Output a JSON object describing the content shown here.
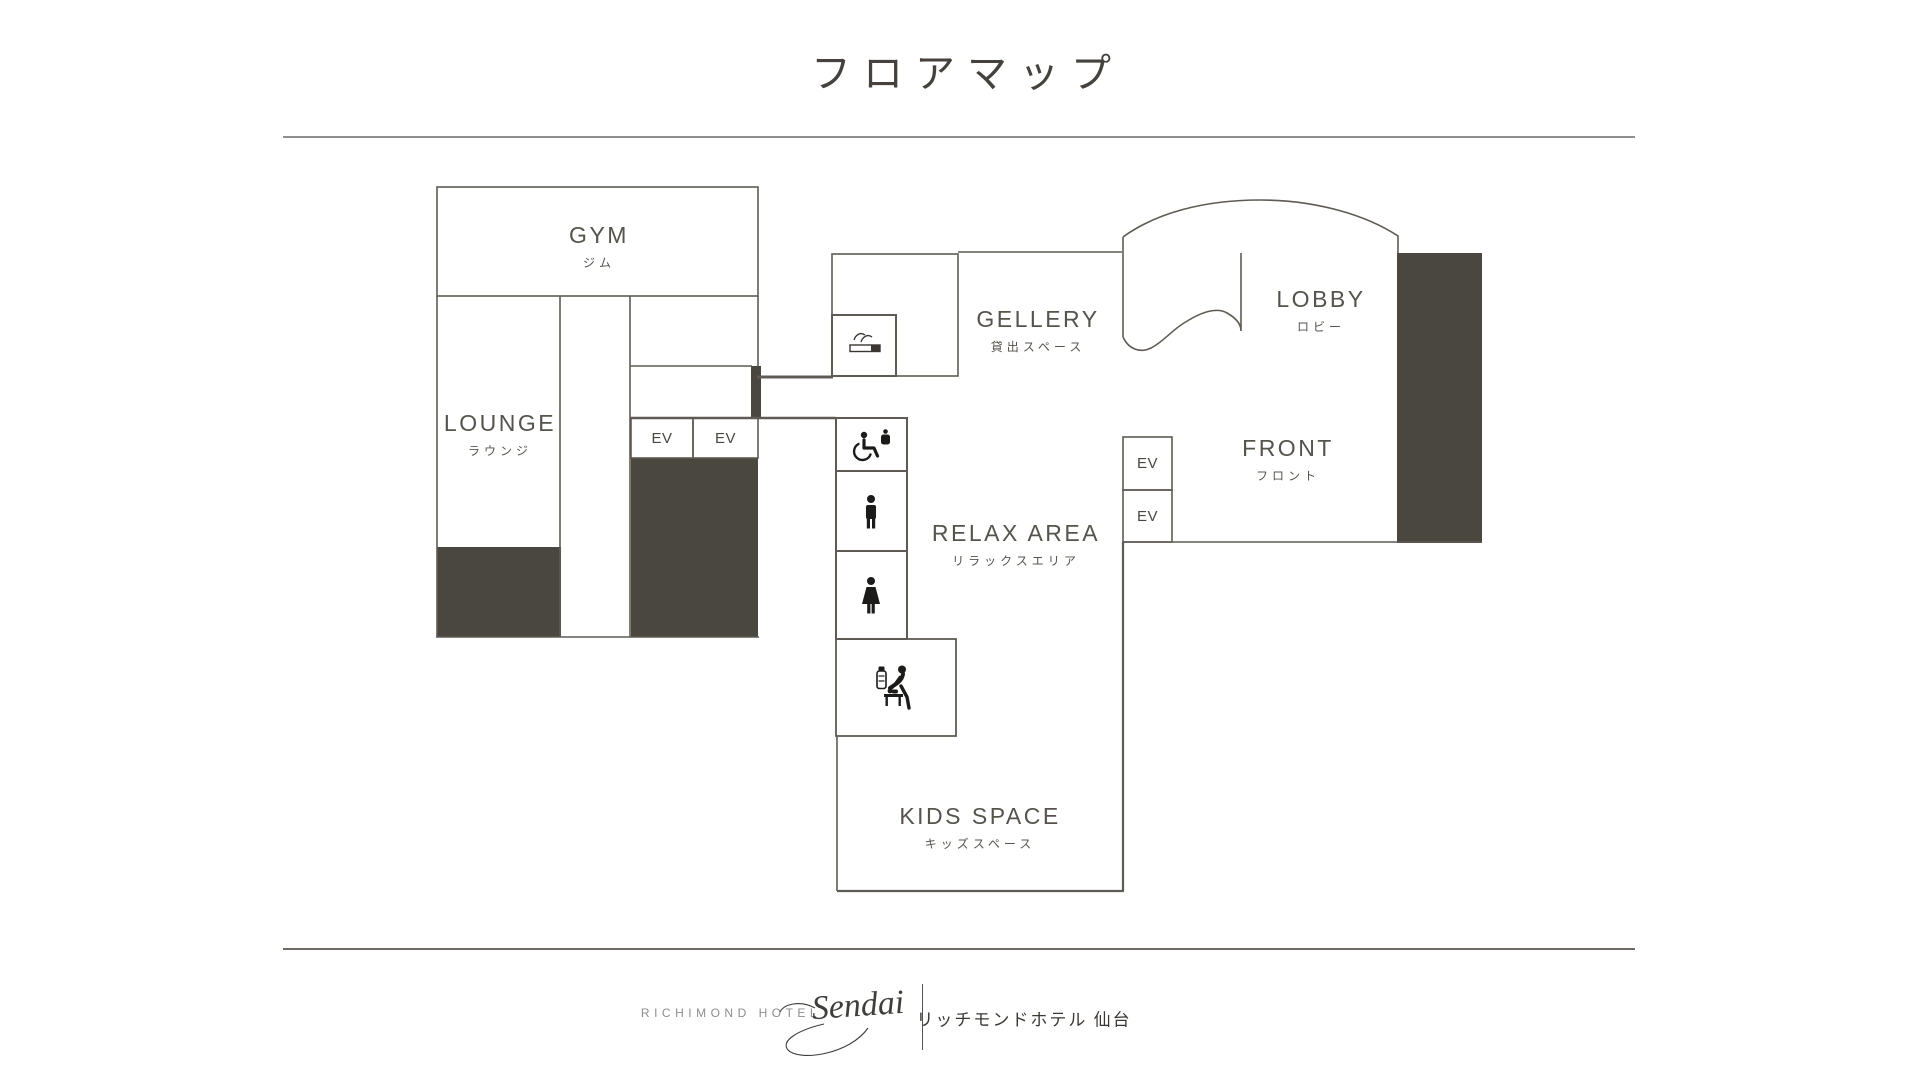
{
  "title": "フロアマップ",
  "colors": {
    "wall": "#5f5b54",
    "dark_fill": "#4a4741",
    "label_text": "#56534d",
    "icon": "#1d1b19",
    "divider_top": "#8f8f8f",
    "divider_bottom": "#6e6a64",
    "footer_gray": "#8d8d8d",
    "footer_dark": "#3b3834",
    "background": "#ffffff"
  },
  "floor_plan": {
    "rooms": {
      "gym": {
        "label": "GYM",
        "label_ja": "ジム"
      },
      "lounge": {
        "label": "LOUNGE",
        "label_ja": "ラウンジ"
      },
      "gellery": {
        "label": "GELLERY",
        "label_ja": "貸出スペース"
      },
      "lobby": {
        "label": "LOBBY",
        "label_ja": "ロビー"
      },
      "front": {
        "label": "FRONT",
        "label_ja": "フロント"
      },
      "relax": {
        "label": "RELAX AREA",
        "label_ja": "リラックスエリア"
      },
      "kids": {
        "label": "KIDS SPACE",
        "label_ja": "キッズスペース"
      }
    },
    "elevator_label": "EV",
    "icons": {
      "smoking": "smoking-icon",
      "accessible_toilet": "accessible-toilet-icon",
      "mens_toilet": "mens-toilet-icon",
      "womens_toilet": "womens-toilet-icon",
      "baby_room": "baby-room-icon"
    }
  },
  "footer": {
    "brand_en": "RICHIMOND HOTEL",
    "brand_script": "Sendai",
    "brand_ja": "リッチモンドホテル 仙台"
  }
}
